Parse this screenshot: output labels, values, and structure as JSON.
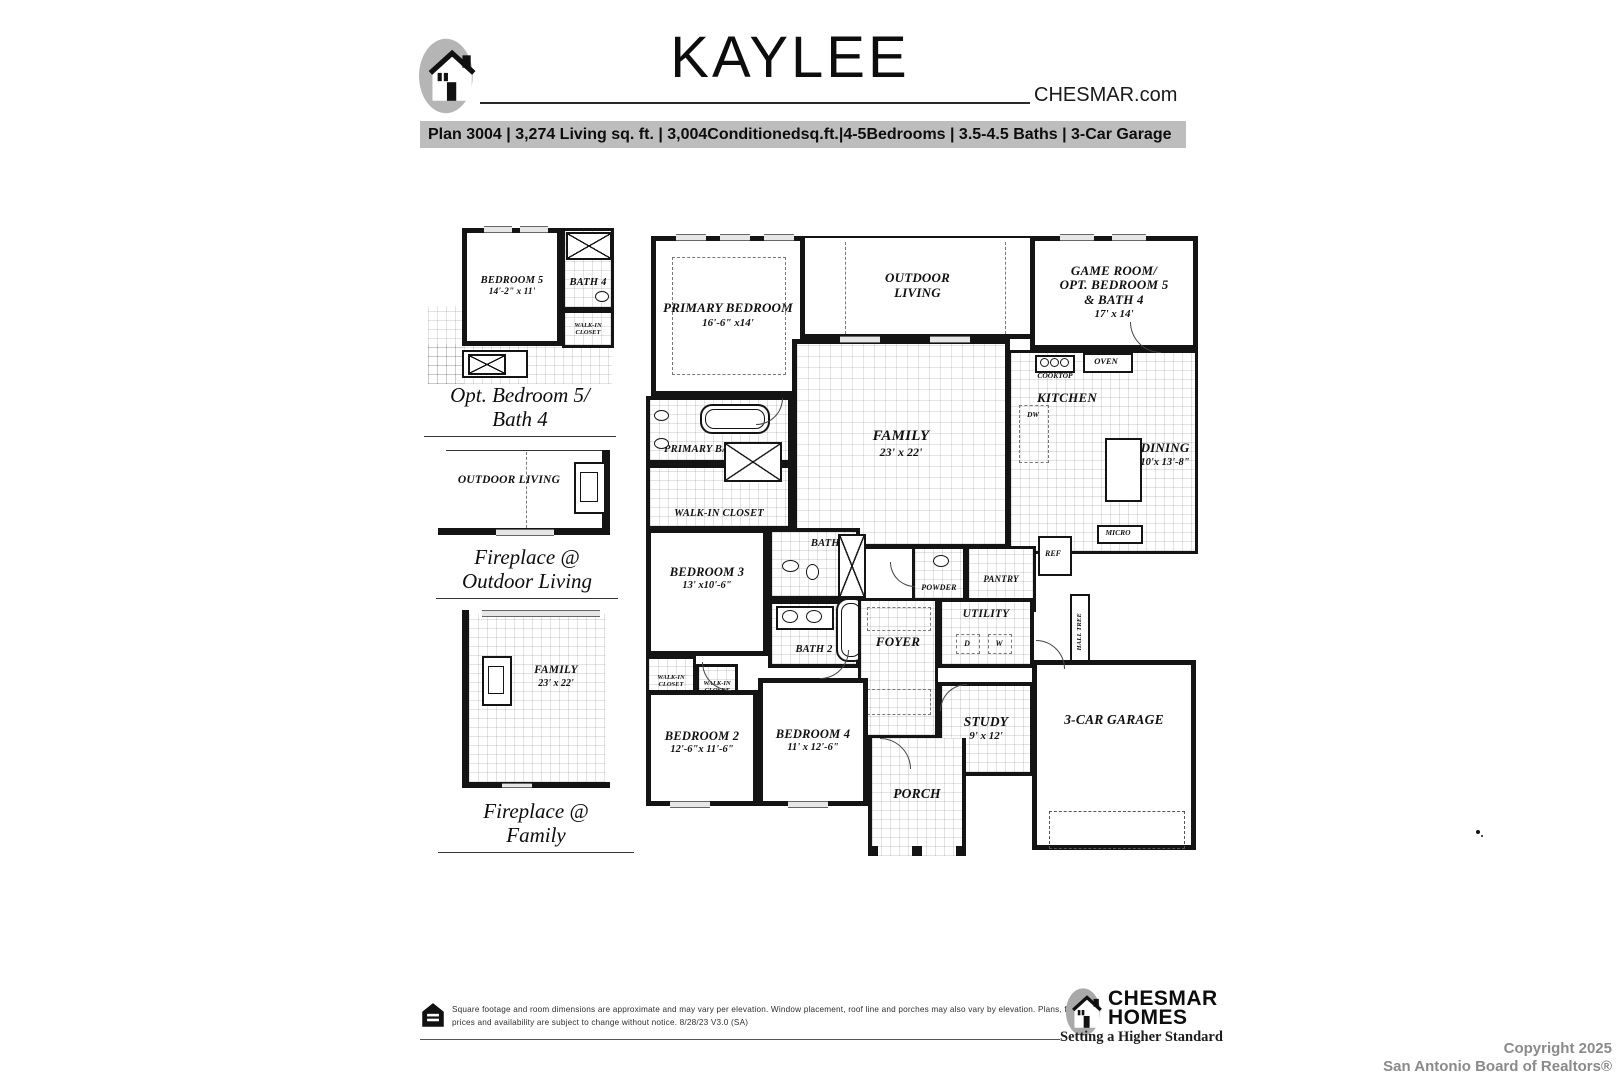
{
  "header": {
    "title": "KAYLEE",
    "website": "CHESMAR.com",
    "specs_bar": "Plan 3004 | 3,274 Living sq. ft. | 3,004Conditionedsq.ft.|4-5Bedrooms | 3.5-4.5 Baths | 3-Car Garage"
  },
  "icons": {
    "brand": "chesmar-c-house-logo",
    "equal_housing": "equal-housing-logo"
  },
  "options": [
    {
      "caption": [
        "Opt. Bedroom 5/",
        "Bath 4"
      ],
      "rooms": [
        {
          "name": "BEDROOM 5",
          "dims": "14'-2\" x 11'"
        },
        {
          "name": "BATH 4"
        },
        {
          "name": "WALK-IN CLOSET"
        }
      ]
    },
    {
      "caption": [
        "Fireplace @",
        "Outdoor Living"
      ],
      "rooms": [
        {
          "name": "OUTDOOR LIVING"
        }
      ]
    },
    {
      "caption": [
        "Fireplace @",
        "Family"
      ],
      "rooms": [
        {
          "name": "FAMILY",
          "dims": "23' x 22'"
        }
      ]
    }
  ],
  "main_plan": {
    "rooms": [
      {
        "name": "PRIMARY BEDROOM",
        "dims": "16'-6\" x14'"
      },
      {
        "name": "OUTDOOR LIVING"
      },
      {
        "line1": "GAME ROOM/",
        "line2": "OPT. BEDROOM 5",
        "line3": "& BATH 4",
        "dims": "17' x 14'"
      },
      {
        "name": "PRIMARY BATH"
      },
      {
        "name": "WALK-IN CLOSET"
      },
      {
        "name": "FAMILY",
        "dims": "23' x 22'"
      },
      {
        "name": "KITCHEN"
      },
      {
        "name": "DINING",
        "dims": "10'x 13'-8\""
      },
      {
        "name": "BATH 3"
      },
      {
        "name": "BATH 2"
      },
      {
        "name": "BEDROOM 3",
        "dims": "13' x10'-6\""
      },
      {
        "name": "WALK-IN CLOSET"
      },
      {
        "name": "WALK-IN CLOSET"
      },
      {
        "name": "POWDER"
      },
      {
        "name": "PANTRY"
      },
      {
        "name": "FOYER"
      },
      {
        "name": "UTILITY"
      },
      {
        "name": "STUDY",
        "dims": "9' x 12'"
      },
      {
        "name": "BEDROOM 2",
        "dims": "12'-6\"x 11'-6\""
      },
      {
        "name": "BEDROOM 4",
        "dims": "11' x 12'-6\""
      },
      {
        "name": "3-CAR GARAGE"
      },
      {
        "name": "PORCH"
      }
    ],
    "fixtures": {
      "cooktop": "COOKTOP",
      "oven": "OVEN",
      "dw": "DW",
      "micro": "MICRO",
      "ref": "REF",
      "dryer": "D",
      "washer": "W",
      "hall_tree": "HALL TREE"
    }
  },
  "footer": {
    "disclaimer_line1": "Square footage and room dimensions are approximate and may vary per elevation. Window placement, roof line and porches may also vary by elevation. Plans, features,",
    "disclaimer_line2": "prices and availability are subject to change without notice.    8/28/23 V3.0 (SA)",
    "brand_line1": "CHESMAR",
    "brand_line2": "HOMES",
    "tagline": "Setting a Higher Standard",
    "copyright_line1": "Copyright 2025",
    "copyright_line2": "San Antonio Board of Realtors®"
  }
}
